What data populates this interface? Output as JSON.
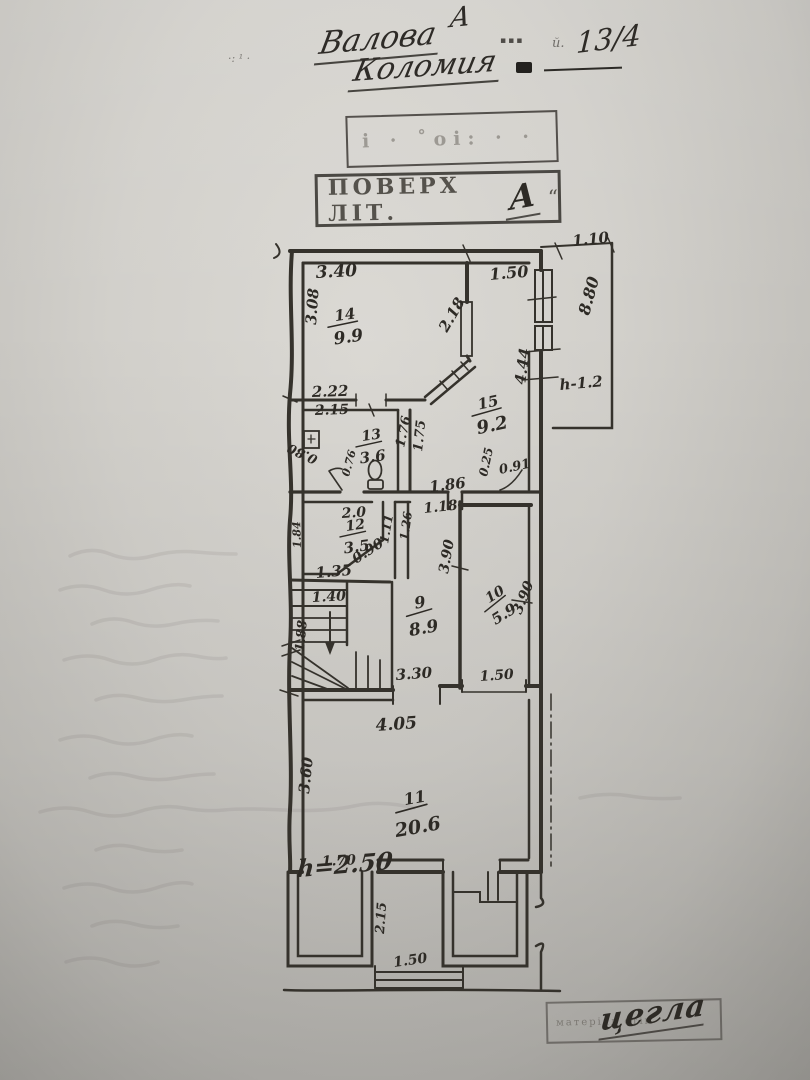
{
  "header": {
    "letter": "А",
    "street": "Валова",
    "city": "Коломия",
    "house_no": "13/4",
    "smudge_left": "·: ¹ ·",
    "smudge_mid": "▪▪▪",
    "smudge_right": "й."
  },
  "stamps": {
    "faint_box_text": "і ·  ˚оі: · ·",
    "floor_label": "ПОВЕРХ ЛІТ.",
    "floor_value": "А",
    "floor_quote": "“",
    "material_label": "матеріал стін",
    "material_value": "цегла"
  },
  "plan": {
    "rooms": {
      "r14": {
        "num": "14",
        "area": "9.9"
      },
      "r15": {
        "num": "15",
        "area": "9.2"
      },
      "r13": {
        "num": "13",
        "area": "3.6"
      },
      "r12": {
        "num": "12",
        "area": "3.5"
      },
      "r9": {
        "num": "9",
        "area": "8.9"
      },
      "r10": {
        "num": "10",
        "area": "5.9"
      },
      "r11": {
        "num": "11",
        "area": "20.6"
      }
    },
    "dims": {
      "top_right": "1.10",
      "room14_top": "3.40",
      "room15_top": "1.50",
      "room14_left": "3.08",
      "partition_diag": "2.18",
      "terrace_right": "8.80",
      "terrace_wall": "4.44",
      "terrace_height": "h-1.2",
      "room13_above": "2.22",
      "room13_top": "2.15",
      "room13_right": "1.76",
      "corridor_wall": "1.75",
      "room13_door_a": "0.80",
      "room13_door_b": "0.76",
      "hall_width": "1.86",
      "room15_bottom_a": "0.25",
      "room15_bottom_b": "0.91",
      "room12_top": "2.0",
      "corridor_top": "1.18",
      "room12_right_a": "1.11",
      "room12_right_b": "1.26",
      "room12_diag": "0.90",
      "room12_bottom": "1.35",
      "room12_left": "1.84",
      "stairs_top": "1.40",
      "stairs_left": "1.88",
      "room9_bottom": "3.30",
      "room10_left": "3.90",
      "room10_right": "3.90",
      "room10_bottom": "1.50",
      "room11_top": "4.05",
      "room11_left": "3.60",
      "room11_bottom_left": "1.70",
      "room11_height": "h=2.50",
      "porch_side": "2.15",
      "steps_width": "1.50"
    }
  }
}
